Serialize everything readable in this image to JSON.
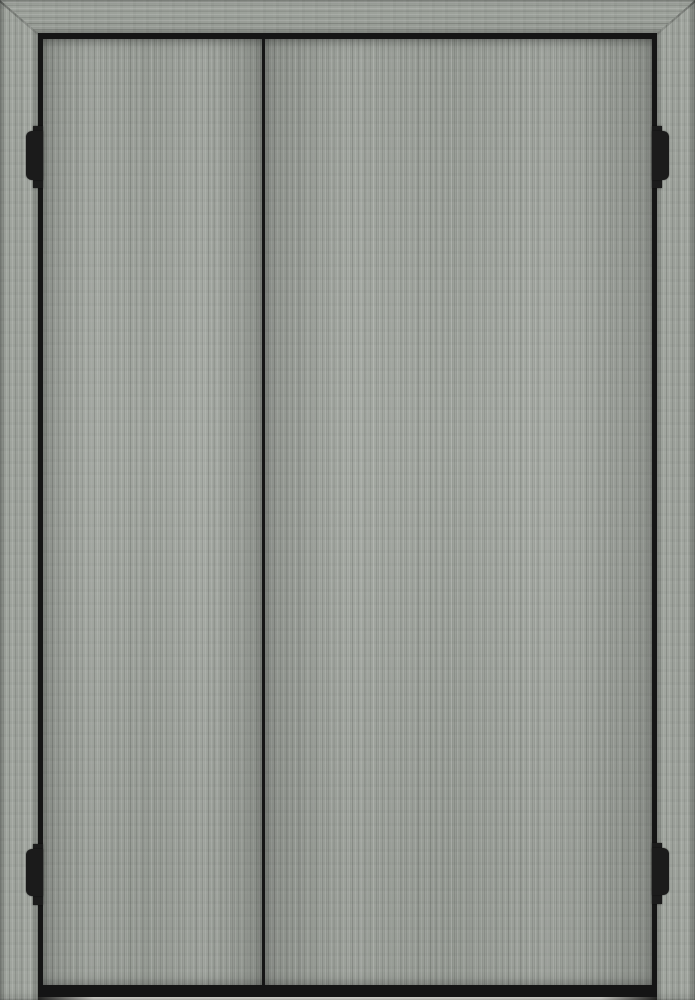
{
  "scene": {
    "title": "Gray two-door cabinet, closed",
    "description": "Front view of a closed double-door cabinet in gray wood-grain finish. A black reveal gap outlines both doors; a narrow vertical gap separates the narrower left door from the wider right door. Two black hinge knuckles show in each side gap, a black shadow band runs under the doors, and a thin strip of light floor is visible at the very bottom.",
    "parts": {
      "frame": "wood cabinet frame with mitered top corners",
      "frame_top": "top frame rail (horizontal grain)",
      "frame_left": "left frame stile (vertical grain)",
      "frame_right": "right frame stile (vertical grain)",
      "gap": "black reveal gap around the doors",
      "left_door": "left door, closed (narrower)",
      "right_door": "right door, closed (wider)",
      "hinge_top_left": "top-left hinge knuckle",
      "hinge_bottom_left": "bottom-left hinge knuckle",
      "hinge_top_right": "top-right hinge knuckle",
      "hinge_bottom_right": "bottom-right hinge knuckle",
      "floor": "light floor strip visible under the doors"
    }
  },
  "colors": {
    "wood-base": "#9da29b",
    "wood-light": "#b6bab1",
    "wood-dark": "#7f847c",
    "gap-black": "#151515",
    "hardware-black": "#1b1b1b",
    "floor-light": "#d2d2cc"
  }
}
